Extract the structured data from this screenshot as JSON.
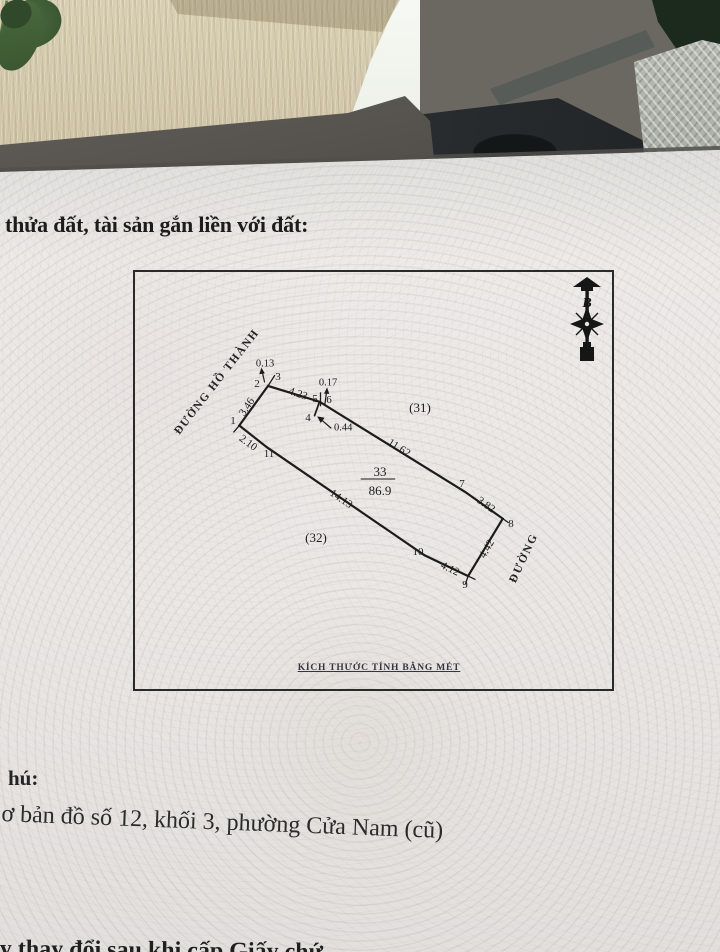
{
  "header": {
    "title_fragment": "thửa đất, tài sản gắn liền với đất:"
  },
  "diagram": {
    "north_label": "B",
    "road_left": "ĐƯỜNG HỒ THÀNH",
    "road_right": "ĐƯỜNG",
    "neighbor_upper": "(31)",
    "neighbor_lower": "(32)",
    "parcel_number": "33",
    "parcel_area": "86.9",
    "units_note": "KÍCH THƯỚC TÍNH BẰNG MÉT",
    "vertices": [
      "1",
      "2",
      "3",
      "4",
      "5",
      "6",
      "7",
      "8",
      "9",
      "10",
      "11"
    ],
    "dims": {
      "edge_1_2": "3.46",
      "edge_3_5": "4.23",
      "edge_6_7": "11.62",
      "edge_7_8": "3.82",
      "edge_8_9": "4.42",
      "edge_9_10": "4.12",
      "edge_10_11": "14.13",
      "edge_11_1": "2.10",
      "offset_2_3": "0.13",
      "offset_5_6": "0.17",
      "offset_4": "0.44"
    }
  },
  "notes": {
    "line1": "hú:",
    "line2": "ơ bản đồ số 12, khối 3, phường Cửa Nam (cũ)",
    "line3": "y thay đổi sau khi cấp Giấy chứ"
  }
}
